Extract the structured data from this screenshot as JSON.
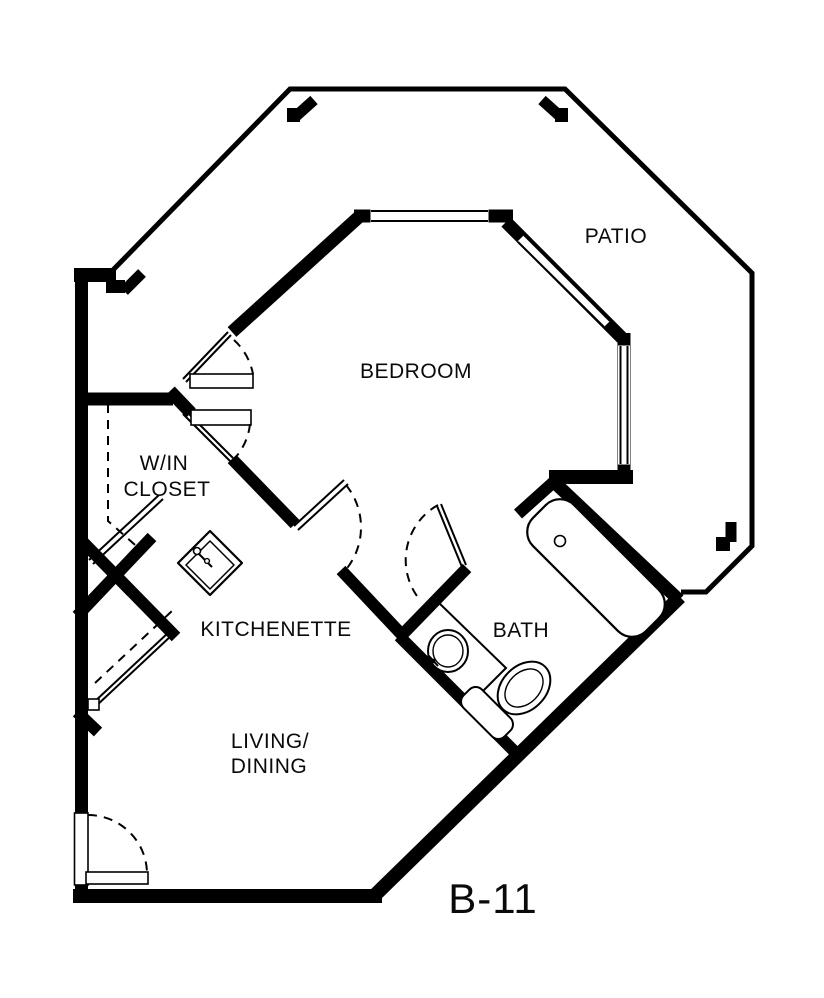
{
  "document": {
    "kind": "architectural floor plan",
    "unit_label": "B-11"
  },
  "rooms": {
    "patio": "PATIO",
    "bedroom": "BEDROOM",
    "closet_line1": "W/IN",
    "closet_line2": "CLOSET",
    "kitchenette": "KITCHENETTE",
    "bath": "BATH",
    "living_line1": "LIVING/",
    "living_line2": "DINING"
  },
  "fixtures": {
    "kitchen_sink": "kitchen-sink",
    "bath_sink": "bath-sink",
    "toilet": "toilet",
    "bathtub": "bathtub"
  },
  "colors": {
    "wall": "#000000",
    "background": "#ffffff",
    "text": "#0a0a0a"
  }
}
